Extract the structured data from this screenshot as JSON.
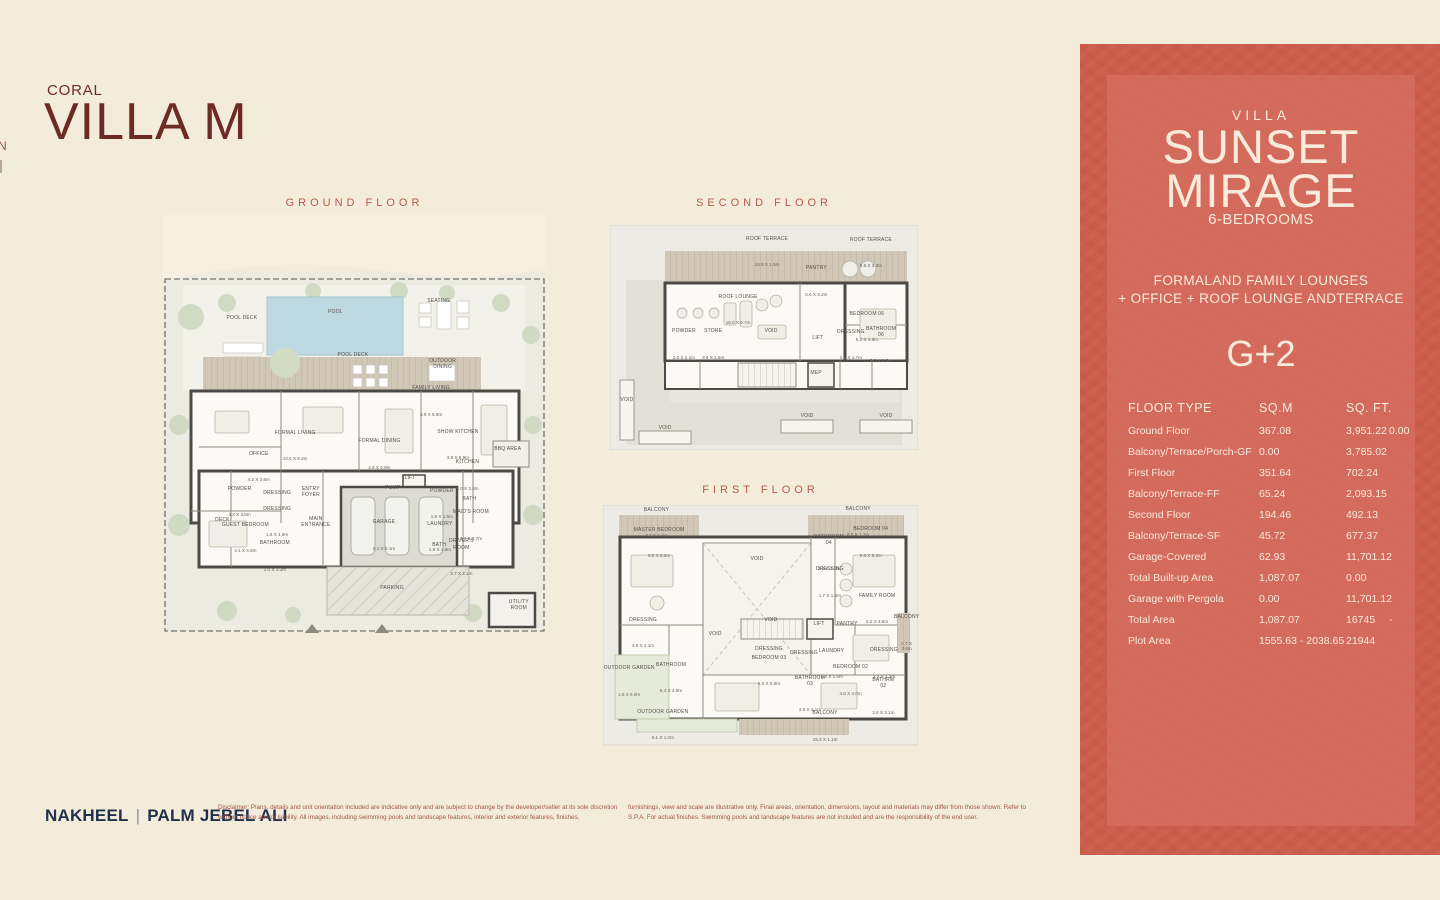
{
  "page": {
    "eyebrow": "CORAL",
    "title": "VILLA M",
    "edge_fragment": "N"
  },
  "plans": {
    "ground": {
      "title": "GROUND FLOOR",
      "rooms": [
        {
          "label": "POOL DECK",
          "x": 20.6,
          "y": 27
        },
        {
          "label": "POOL",
          "x": 45,
          "y": 25.4
        },
        {
          "label": "SEATING",
          "x": 72,
          "y": 22.8
        },
        {
          "label": "POOL DECK",
          "x": 49.6,
          "y": 35.7
        },
        {
          "label": "OUTDOOR\nDINING",
          "x": 73,
          "y": 37.8
        },
        {
          "label": "FAMILY LIVING",
          "dims": "3.9 X 5.9m",
          "x": 70,
          "y": 44.4
        },
        {
          "label": "FORMAL LIVING",
          "dims": "12.5 X 6.2m",
          "x": 34.5,
          "y": 55
        },
        {
          "label": "FORMAL DINING",
          "dims": "4.5 X 5.9m",
          "x": 56.5,
          "y": 57
        },
        {
          "label": "SHOW KITCHEN",
          "dims": "3.9 X 5.9m",
          "x": 77,
          "y": 54.7
        },
        {
          "label": "BBQ AREA",
          "x": 90,
          "y": 58
        },
        {
          "label": "OFFICE",
          "dims": "4.2 X 3.6m",
          "x": 25,
          "y": 60
        },
        {
          "label": "KITCHEN",
          "dims": "4.0 X 3.8m",
          "x": 79.5,
          "y": 62
        },
        {
          "label": "LIFT",
          "x": 64.5,
          "y": 65
        },
        {
          "label": "PUMP",
          "x": 60,
          "y": 67.4
        },
        {
          "label": "ENTRY\nFOYER",
          "x": 38.6,
          "y": 68.3
        },
        {
          "label": "POWDER",
          "dims": "4.2 X 3.8m",
          "x": 20,
          "y": 68.3
        },
        {
          "label": "DRESSING",
          "x": 29.8,
          "y": 68.6
        },
        {
          "label": "POWDER",
          "dims": "1.9 X 1.6m",
          "x": 72.8,
          "y": 68.8
        },
        {
          "label": "BATH",
          "x": 80,
          "y": 70
        },
        {
          "label": "DRESSING",
          "dims": "1.6 X 1.9m",
          "x": 29.8,
          "y": 73.1
        },
        {
          "label": "DECK",
          "x": 15.5,
          "y": 75
        },
        {
          "label": "GUEST BEDROOM",
          "dims": "4.1 X 4.8m",
          "x": 21.5,
          "y": 76.8
        },
        {
          "label": "MAIN\nENTRANCE",
          "x": 39.9,
          "y": 75.5
        },
        {
          "label": "GARAGE",
          "dims": "9.1 X 6.1m",
          "x": 57.7,
          "y": 76.3
        },
        {
          "label": "MAID'S ROOM",
          "dims": "3.7 X 2.7m",
          "x": 80.4,
          "y": 73.9
        },
        {
          "label": "LAUNDRY",
          "dims": "1.9 X 1.9m",
          "x": 72.3,
          "y": 76.7
        },
        {
          "label": "BATH",
          "x": 72.1,
          "y": 81
        },
        {
          "label": "DRIVER'S\nROOM",
          "dims": "3.7 X 2.1m",
          "x": 77.9,
          "y": 81.5
        },
        {
          "label": "BATHROOM",
          "dims": "2.0 X 3.3m",
          "x": 29.2,
          "y": 81.3
        },
        {
          "label": "PARKING",
          "x": 59.8,
          "y": 91.1
        },
        {
          "label": "UTILITY\nROOM",
          "x": 92.9,
          "y": 95.2
        }
      ]
    },
    "second": {
      "title": "SECOND FLOOR",
      "rooms": [
        {
          "label": "ROOF TERRACE",
          "dims": "16.5 X 1.5m",
          "x": 51,
          "y": 12
        },
        {
          "label": "ROOF TERRACE",
          "dims": "5.5 X 3.3m",
          "x": 84.7,
          "y": 12.4
        },
        {
          "label": "PANTRY",
          "dims": "2.6 X 4.2m",
          "x": 67,
          "y": 25
        },
        {
          "label": "ROOF LOUNGE",
          "dims": "16.0 X 6.7m",
          "x": 41.6,
          "y": 37.8
        },
        {
          "label": "BEDROOM 06",
          "dims": "5.2 X 4.9m",
          "x": 83.4,
          "y": 45.3
        },
        {
          "label": "POWDER",
          "dims": "2.0 X 2.1m",
          "x": 24,
          "y": 53
        },
        {
          "label": "STORE",
          "dims": "3.6 X 1.5m",
          "x": 33.5,
          "y": 53
        },
        {
          "label": "VOID",
          "x": 52.3,
          "y": 51.6
        },
        {
          "label": "LIFT",
          "x": 67.5,
          "y": 54.7
        },
        {
          "label": "DRESSING",
          "dims": "2.1 X 1.7m",
          "x": 78.2,
          "y": 53.3
        },
        {
          "label": "BATHROOM 06",
          "dims": "3.0 X 2.3m",
          "x": 88,
          "y": 53.3
        },
        {
          "label": "MEP",
          "x": 66.9,
          "y": 70.2
        },
        {
          "label": "VOID",
          "x": 5.5,
          "y": 82.2
        },
        {
          "label": "VOID",
          "x": 17.9,
          "y": 94.7
        },
        {
          "label": "VOID",
          "x": 64,
          "y": 89.3
        },
        {
          "label": "VOID",
          "x": 89.6,
          "y": 89.3
        }
      ]
    },
    "first": {
      "title": "FIRST FLOOR",
      "rooms": [
        {
          "label": "BALCONY",
          "dims": "7.1 X 1.7m",
          "x": 17,
          "y": 7.5
        },
        {
          "label": "BALCONY",
          "dims": "8.6 X 1.7m",
          "x": 81,
          "y": 7.1
        },
        {
          "label": "MASTER BEDROOM",
          "dims": "6.9 X 6.2m",
          "x": 17.8,
          "y": 15.8
        },
        {
          "label": "VOID",
          "x": 48.9,
          "y": 26.3
        },
        {
          "label": "BATHROOM\n04",
          "dims": "2.3 X 1.2m",
          "x": 71.7,
          "y": 19.8
        },
        {
          "label": "BEDROOM 04",
          "dims": "5.8 X 5.2m",
          "x": 85,
          "y": 15.4
        },
        {
          "label": "DRESSING",
          "dims": "1.7 X 1.8m",
          "x": 72,
          "y": 32
        },
        {
          "label": "FAMILY ROOM",
          "dims": "5.2 X 4.6m",
          "x": 87,
          "y": 43
        },
        {
          "label": "DRESSING",
          "dims": "3.0 X 4.1m",
          "x": 12.7,
          "y": 52.9
        },
        {
          "label": "VOID",
          "x": 35.6,
          "y": 57.4
        },
        {
          "label": "VOID",
          "x": 53.3,
          "y": 51.7
        },
        {
          "label": "LIFT",
          "x": 68.6,
          "y": 53.2
        },
        {
          "label": "PANTRY",
          "x": 77.5,
          "y": 53.3
        },
        {
          "label": "OUTDOOR GARDEN",
          "dims": "1.6 X 6.0m",
          "x": 8.3,
          "y": 72.9
        },
        {
          "label": "BATHROOM",
          "dims": "5.4 X 4.8m",
          "x": 21.6,
          "y": 71.5
        },
        {
          "label": "DRESSING",
          "x": 52.7,
          "y": 63.5
        },
        {
          "label": "BEDROOM 03",
          "dims": "5.0 X 5.5m",
          "x": 52.7,
          "y": 68.5
        },
        {
          "label": "DRESSING",
          "x": 63.8,
          "y": 65.3
        },
        {
          "label": "LAUNDRY",
          "dims": "1.4 X 1.9m",
          "x": 72.6,
          "y": 65.7
        },
        {
          "label": "DRESSING",
          "dims": "2.2 X 1.3m",
          "x": 89.2,
          "y": 65.4
        },
        {
          "label": "BATHROOM\n03",
          "dims": "2.6 X 3.1m",
          "x": 65.7,
          "y": 78
        },
        {
          "label": "BEDROOM 02",
          "dims": "4.6 X 4.0m",
          "x": 78.6,
          "y": 72.5
        },
        {
          "label": "BATHRM\n02",
          "dims": "2.6 X 3.1m",
          "x": 89,
          "y": 79
        },
        {
          "label": "BALCONY",
          "dims": "15.3 X 1.1m",
          "x": 70.5,
          "y": 91.5
        },
        {
          "label": "OUTDOOR GARDEN",
          "dims": "6.1 X 1.0m",
          "x": 19,
          "y": 91
        },
        {
          "label": "BALCONY",
          "dims": "0.7 X\n3.6m",
          "x": 96.4,
          "y": 53
        }
      ]
    }
  },
  "panel": {
    "villa_label": "VILLA",
    "name_line1": "SUNSET",
    "name_line2": "MIRAGE",
    "bedrooms": "6-BEDROOMS",
    "features_line1": "FORMALAND FAMILY LOUNGES",
    "features_line2": "+ OFFICE + ROOF LOUNGE ANDTERRACE",
    "storeys": "G+2",
    "table": {
      "headers": [
        "FLOOR TYPE",
        "SQ.M",
        "SQ. FT."
      ],
      "rows": [
        {
          "label": "Ground Floor",
          "sqm": "367.08",
          "sqft": "3,951.22",
          "extra": "0.00"
        },
        {
          "label": "Balcony/Terrace/Porch-GF",
          "sqm": "0.00",
          "sqft": "3,785.02"
        },
        {
          "label": "First Floor",
          "sqm": "351.64",
          "sqft": "702.24"
        },
        {
          "label": "Balcony/Terrace-FF",
          "sqm": "65.24",
          "sqft": "2,093.15"
        },
        {
          "label": "Second Floor",
          "sqm": "194.46",
          "sqft": "492.13"
        },
        {
          "label": "Balcony/Terrace-SF",
          "sqm": "45.72",
          "sqft": "677.37"
        },
        {
          "label": "Garage-Covered",
          "sqm": "62.93",
          "sqft": "11,701.12"
        },
        {
          "label": "Total Built-up Area",
          "sqm": "1,087.07",
          "sqft": "0.00"
        },
        {
          "label": "Garage with Pergola",
          "sqm": "0.00",
          "sqft": "11,701.12"
        },
        {
          "label": "Total Area",
          "sqm": "1,087.07",
          "sqft": "16745",
          "extra": "-"
        },
        {
          "label": "Plot Area",
          "sqm": "1555.63 - 2038.65",
          "sqft": "21944"
        }
      ]
    }
  },
  "footer": {
    "brand_left": "NAKHEEL",
    "separator": "|",
    "brand_right": "PALM JEBEL ALI",
    "disclaimer_col1": "Disclaimer: Plans, details and unit orientation included are indicative only and are subject to change by the developer/seller at its sole discretion without notice and/or liability. All images, including swimming pools and landscape features, interior and exterior features, finishes,",
    "disclaimer_col2": "furnishings, view and scale are illustrative only. Final areas, orientation, dimensions, layout and materials may differ from those shown. Refer to S.P.A. For actual finishes. Swimming pools and landscape features are not included and are the responsibility of the end user."
  }
}
